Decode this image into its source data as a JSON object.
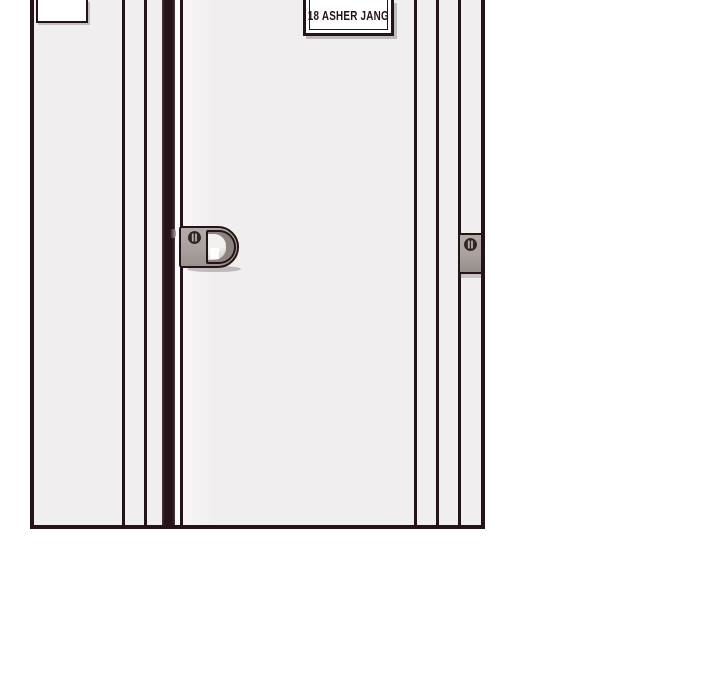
{
  "scene": {
    "nameplate": {
      "text": "18 ASHER JANG"
    },
    "blank_plaque": {
      "text": ""
    },
    "icons": {
      "handle_screw": "screw-icon",
      "strike_screw": "screw-icon"
    },
    "colors": {
      "page-bg": "#ffffff",
      "wall": "#f0eeee",
      "outline": "#241419",
      "door-gap": "#261218",
      "metal": "#a8a19d",
      "metal-dark": "#8d8480",
      "metal-light": "#edebea",
      "shadow": "#b7b1ae",
      "plate-bg": "#ffffff",
      "text": "#241418"
    }
  }
}
